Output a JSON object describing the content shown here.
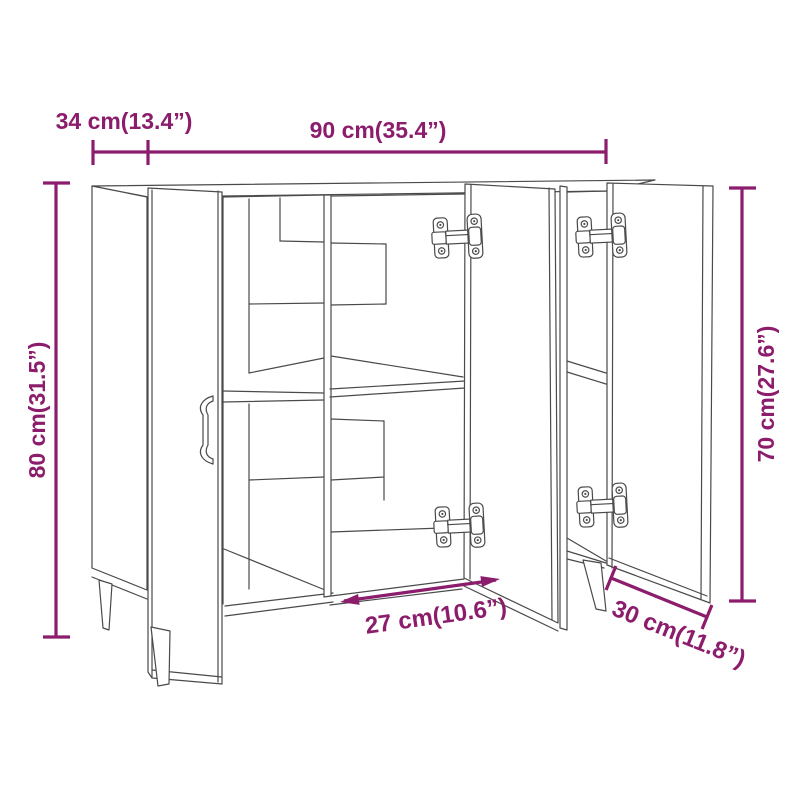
{
  "image": {
    "background_color": "#ffffff",
    "line_art_color": "#4a4a4a",
    "dimension_color": "#8c1c6c",
    "subject": "Line drawing of a sideboard with three open doors, interior shelves, concealed hinges and tapered legs, annotated with product dimensions"
  },
  "drawing": {
    "parts": [
      "cabinet-top",
      "left-side-panel",
      "left-door",
      "door-handle",
      "center-divider",
      "middle-shelf",
      "middle-door",
      "right-divider",
      "right-door",
      "hinges",
      "tapered-legs"
    ]
  },
  "dims": {
    "d34": {
      "label": "34 cm(13.4”)",
      "position": "top-left",
      "orientation": "horizontal"
    },
    "d90": {
      "label": "90 cm(35.4”)",
      "position": "top-center",
      "orientation": "horizontal"
    },
    "d80": {
      "label": "80 cm(31.5”)",
      "position": "left",
      "orientation": "vertical"
    },
    "d70": {
      "label": "70 cm(27.6”)",
      "position": "right",
      "orientation": "vertical"
    },
    "d27": {
      "label": "27 cm(10.6”)",
      "position": "bottom-center",
      "orientation": "diagonal"
    },
    "d30": {
      "label": "30 cm(11.8”)",
      "position": "bottom-right",
      "orientation": "diagonal"
    }
  }
}
